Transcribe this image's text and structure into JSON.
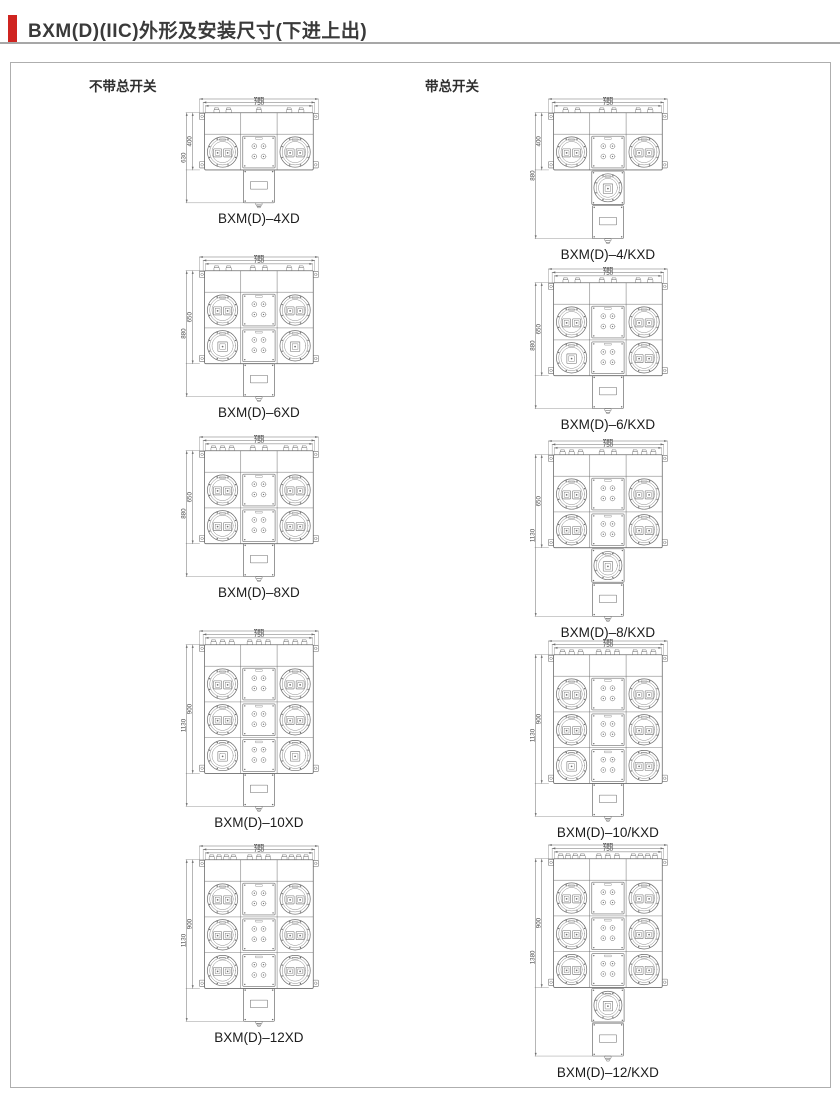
{
  "page": {
    "title": "BXM(D)(IIC)外形及安装尺寸(下进上出)",
    "accent_color": "#cf2420",
    "rule_color": "#a7a7a7"
  },
  "sections": {
    "left_header": "不带总开关",
    "right_header": "带总开关"
  },
  "width_dims": [
    "830",
    "780",
    "750"
  ],
  "columns": {
    "left": [
      {
        "label": "BXM(D)–4XD",
        "outer_height": "630",
        "inner_height": "400",
        "rows": [
          [
            2,
            2
          ]
        ],
        "main_switch": false,
        "glands": [
          2,
          1,
          2
        ]
      },
      {
        "label": "BXM(D)–6XD",
        "outer_height": "880",
        "inner_height": "650",
        "rows": [
          [
            2,
            2
          ],
          [
            1,
            1
          ]
        ],
        "main_switch": false,
        "glands": [
          2,
          2,
          2
        ]
      },
      {
        "label": "BXM(D)–8XD",
        "outer_height": "880",
        "inner_height": "650",
        "rows": [
          [
            2,
            2
          ],
          [
            2,
            2
          ]
        ],
        "main_switch": false,
        "glands": [
          3,
          2,
          3
        ]
      },
      {
        "label": "BXM(D)–10XD",
        "outer_height": "1130",
        "inner_height": "900",
        "rows": [
          [
            2,
            2
          ],
          [
            2,
            2
          ],
          [
            1,
            1
          ]
        ],
        "main_switch": false,
        "glands": [
          3,
          3,
          3
        ]
      },
      {
        "label": "BXM(D)–12XD",
        "outer_height": "1130",
        "inner_height": "900",
        "rows": [
          [
            2,
            2
          ],
          [
            2,
            2
          ],
          [
            2,
            2
          ]
        ],
        "main_switch": false,
        "glands": [
          4,
          3,
          4
        ]
      }
    ],
    "right": [
      {
        "label": "BXM(D)–4/KXD",
        "outer_height": "880",
        "inner_height": "400",
        "rows": [
          [
            2,
            2
          ]
        ],
        "main_switch": true,
        "glands": [
          2,
          2,
          2
        ]
      },
      {
        "label": "BXM(D)–6/KXD",
        "outer_height": "880",
        "inner_height": "650",
        "rows": [
          [
            2,
            2
          ],
          [
            1,
            2
          ]
        ],
        "main_switch": false,
        "glands": [
          2,
          2,
          2
        ]
      },
      {
        "label": "BXM(D)–8/KXD",
        "outer_height": "1130",
        "inner_height": "650",
        "rows": [
          [
            2,
            2
          ],
          [
            2,
            2
          ]
        ],
        "main_switch": true,
        "glands": [
          3,
          2,
          3
        ]
      },
      {
        "label": "BXM(D)–10/KXD",
        "outer_height": "1130",
        "inner_height": "900",
        "rows": [
          [
            2,
            2
          ],
          [
            2,
            2
          ],
          [
            1,
            2
          ]
        ],
        "main_switch": false,
        "glands": [
          3,
          3,
          3
        ]
      },
      {
        "label": "BXM(D)–12/KXD",
        "outer_height": "1380",
        "inner_height": "900",
        "rows": [
          [
            2,
            2
          ],
          [
            2,
            2
          ],
          [
            2,
            2
          ]
        ],
        "main_switch": true,
        "glands": [
          4,
          3,
          4
        ]
      }
    ]
  }
}
